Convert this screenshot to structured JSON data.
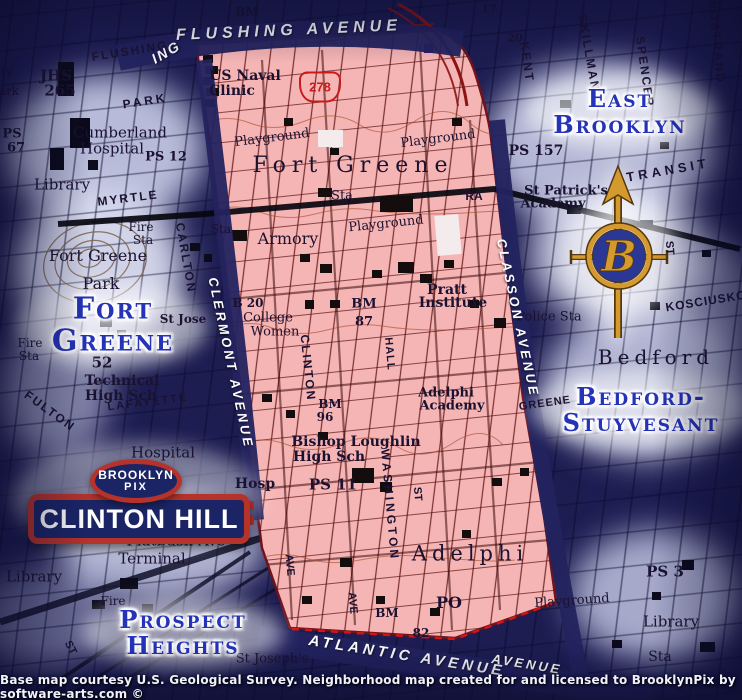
{
  "palette": {
    "ink": "#1a1230",
    "white": "#ffffff",
    "label_blue": "#2433b8",
    "pink": "#f6b5b5",
    "band_blue": "#23235f",
    "sign_red": "#b5332a",
    "sign_navy": "#1b2566",
    "gold": "#d59a2e",
    "shield_red": "#cc1a1a"
  },
  "banners": {
    "flushing": "FLUSHING AVENUE",
    "atlantic": "ATLANTIC AVENUE",
    "clermont": "CLERMONT AVENUE",
    "classon": "CLASSON AVENUE"
  },
  "sign": {
    "oval_top": "BROOKLYN",
    "oval_bottom": "PIX",
    "name": "CLINTON HILL"
  },
  "logo": {
    "letter": "B"
  },
  "shield": {
    "number": "278"
  },
  "footer": {
    "text": "Base map courtesy U.S. Geological Survey. Neighborhood map created for and licensed to BrooklynPix by software-arts.com ©"
  },
  "neighborhoods": [
    {
      "id": "east-brooklyn",
      "lines": [
        "East",
        "Brooklyn"
      ],
      "x": 620,
      "y": 112,
      "s": 24
    },
    {
      "id": "fort-greene",
      "lines": [
        "Fort",
        "Greene"
      ],
      "x": 113,
      "y": 326,
      "s": 30
    },
    {
      "id": "bedford-stuyvesant",
      "lines": [
        "Bedford-",
        "Stuyvesant"
      ],
      "x": 641,
      "y": 410,
      "s": 24
    },
    {
      "id": "prospect-heights",
      "lines": [
        "Prospect",
        "Heights"
      ],
      "x": 183,
      "y": 633,
      "s": 24
    }
  ],
  "map_labels": [
    {
      "t": "JHS",
      "x": 56,
      "y": 76,
      "s": 15,
      "b": 1
    },
    {
      "t": "265",
      "x": 60,
      "y": 91,
      "s": 15,
      "b": 1
    },
    {
      "t": "FLUSHING",
      "x": 130,
      "y": 51,
      "r": -9,
      "f": "sans",
      "sp": 2,
      "s": 12,
      "b": 1
    },
    {
      "t": "PARK",
      "x": 145,
      "y": 101,
      "r": -9,
      "f": "sans",
      "sp": 3,
      "s": 12,
      "b": 1
    },
    {
      "t": "ty",
      "x": 7,
      "y": 72,
      "s": 12
    },
    {
      "t": "ark",
      "x": 9,
      "y": 91,
      "s": 12
    },
    {
      "t": "PS",
      "x": 12,
      "y": 134,
      "s": 13,
      "b": 1
    },
    {
      "t": "67",
      "x": 16,
      "y": 148,
      "s": 13,
      "b": 1
    },
    {
      "t": "Cumberland",
      "x": 120,
      "y": 133,
      "s": 15
    },
    {
      "t": "Hospital",
      "x": 112,
      "y": 149,
      "s": 15
    },
    {
      "t": "PS 12",
      "x": 166,
      "y": 157,
      "s": 13,
      "b": 1
    },
    {
      "t": "Library",
      "x": 62,
      "y": 185,
      "s": 15
    },
    {
      "t": "MYRTLE",
      "x": 128,
      "y": 198,
      "r": -7,
      "f": "sans",
      "sp": 2,
      "s": 12,
      "b": 1
    },
    {
      "t": "Fire",
      "x": 141,
      "y": 227,
      "s": 12
    },
    {
      "t": "Sta",
      "x": 143,
      "y": 240,
      "s": 12
    },
    {
      "t": "Fort Greene",
      "x": 98,
      "y": 256,
      "s": 16
    },
    {
      "t": "Park",
      "x": 101,
      "y": 284,
      "s": 16
    },
    {
      "t": "CARLTON",
      "x": 186,
      "y": 258,
      "r": 80,
      "f": "sans",
      "sp": 2,
      "s": 12,
      "b": 1
    },
    {
      "t": "St Jose",
      "x": 183,
      "y": 319,
      "s": 12,
      "b": 1
    },
    {
      "t": "Fire",
      "x": 30,
      "y": 343,
      "s": 12
    },
    {
      "t": "Sta",
      "x": 29,
      "y": 356,
      "s": 12
    },
    {
      "t": "52",
      "x": 102,
      "y": 363,
      "s": 15,
      "b": 1
    },
    {
      "t": "Technical",
      "x": 122,
      "y": 381,
      "s": 14,
      "b": 1
    },
    {
      "t": "High Sch",
      "x": 121,
      "y": 396,
      "s": 14,
      "b": 1
    },
    {
      "t": "FULTON",
      "x": 50,
      "y": 411,
      "r": 36,
      "f": "sans",
      "sp": 2,
      "s": 12,
      "b": 1
    },
    {
      "t": "LAFAYETTE",
      "x": 148,
      "y": 403,
      "r": -7,
      "f": "sans",
      "sp": 2,
      "s": 11,
      "b": 1
    },
    {
      "t": "Hospital",
      "x": 163,
      "y": 453,
      "s": 15
    },
    {
      "t": "Flatbush Ave",
      "x": 176,
      "y": 541,
      "s": 15
    },
    {
      "t": "Terminal",
      "x": 152,
      "y": 559,
      "s": 15
    },
    {
      "t": "Library",
      "x": 34,
      "y": 577,
      "s": 15
    },
    {
      "t": "Fire",
      "x": 113,
      "y": 601,
      "s": 12
    },
    {
      "t": "ST",
      "x": 70,
      "y": 648,
      "r": 62,
      "f": "sans",
      "s": 11,
      "b": 1
    },
    {
      "t": "St Joseph's",
      "x": 272,
      "y": 659,
      "s": 13
    },
    {
      "t": "17",
      "x": 489,
      "y": 9,
      "s": 11,
      "b": 1
    },
    {
      "t": "20",
      "x": 515,
      "y": 38,
      "s": 11,
      "b": 1
    },
    {
      "t": "KENT",
      "x": 527,
      "y": 62,
      "r": 82,
      "f": "sans",
      "sp": 2,
      "s": 12,
      "b": 1
    },
    {
      "t": "SKILLMAN",
      "x": 589,
      "y": 53,
      "r": 80,
      "f": "sans",
      "sp": 2,
      "s": 12,
      "b": 1
    },
    {
      "t": "SPENCER",
      "x": 645,
      "y": 72,
      "r": 82,
      "f": "sans",
      "sp": 2,
      "s": 12,
      "b": 1
    },
    {
      "t": "NOSTRAND",
      "x": 717,
      "y": 42,
      "r": 84,
      "f": "sans",
      "sp": 2,
      "s": 12,
      "b": 1
    },
    {
      "t": "PS 157",
      "x": 536,
      "y": 151,
      "s": 14,
      "b": 1
    },
    {
      "t": "TRANSIT",
      "x": 668,
      "y": 170,
      "r": -10,
      "f": "sans",
      "sp": 4,
      "s": 13,
      "b": 1
    },
    {
      "t": "St Patrick's",
      "x": 566,
      "y": 191,
      "s": 13,
      "b": 1
    },
    {
      "t": "Academy",
      "x": 553,
      "y": 204,
      "s": 13,
      "b": 1
    },
    {
      "t": "ST",
      "x": 669,
      "y": 248,
      "r": 85,
      "f": "sans",
      "s": 11,
      "b": 1
    },
    {
      "t": "Police Sta",
      "x": 549,
      "y": 317,
      "s": 13
    },
    {
      "t": "Bedford",
      "x": 656,
      "y": 357,
      "s": 20,
      "sp": 5
    },
    {
      "t": "GREENE",
      "x": 545,
      "y": 404,
      "r": -8,
      "f": "sans",
      "sp": 1,
      "s": 11,
      "b": 1
    },
    {
      "t": "KOSCIUSKO",
      "x": 706,
      "y": 301,
      "r": -9,
      "f": "sans",
      "sp": 1,
      "s": 12,
      "b": 1
    },
    {
      "t": "PS 3",
      "x": 665,
      "y": 572,
      "s": 15,
      "b": 1
    },
    {
      "t": "Library",
      "x": 671,
      "y": 622,
      "s": 15
    },
    {
      "t": "Sta",
      "x": 660,
      "y": 657,
      "s": 14
    },
    {
      "t": "Playground",
      "x": 572,
      "y": 601,
      "r": -4,
      "s": 13
    },
    {
      "t": "BM",
      "x": 247,
      "y": 12,
      "s": 12,
      "b": 1
    },
    {
      "t": "ING",
      "x": 166,
      "y": 52,
      "r": -30,
      "c": "white",
      "f": "sans",
      "i": 1,
      "b": 1,
      "s": 14,
      "sp": 2
    },
    {
      "t": "US Naval",
      "x": 245,
      "y": 76,
      "s": 14,
      "b": 1
    },
    {
      "t": "Clinic",
      "x": 232,
      "y": 91,
      "s": 14,
      "b": 1
    },
    {
      "t": "Playground",
      "x": 272,
      "y": 138,
      "r": -7,
      "s": 13
    },
    {
      "t": "Playground",
      "x": 438,
      "y": 139,
      "r": -7,
      "s": 13
    },
    {
      "t": "Fort Greene",
      "x": 353,
      "y": 166,
      "s": 22,
      "sp": 6
    },
    {
      "t": "Sta",
      "x": 342,
      "y": 196,
      "s": 13
    },
    {
      "t": "Sta",
      "x": 221,
      "y": 229,
      "s": 12
    },
    {
      "t": "RA",
      "x": 474,
      "y": 196,
      "f": "sans",
      "s": 12,
      "b": 1
    },
    {
      "t": "Playground",
      "x": 386,
      "y": 224,
      "r": -6,
      "s": 13
    },
    {
      "t": "Armory",
      "x": 288,
      "y": 239,
      "s": 16
    },
    {
      "t": "B 20",
      "x": 248,
      "y": 303,
      "s": 12,
      "b": 1
    },
    {
      "t": "College",
      "x": 268,
      "y": 318,
      "s": 13
    },
    {
      "t": "Women",
      "x": 275,
      "y": 332,
      "s": 13
    },
    {
      "t": "BM",
      "x": 364,
      "y": 304,
      "s": 13,
      "b": 1
    },
    {
      "t": "87",
      "x": 364,
      "y": 322,
      "s": 13,
      "b": 1
    },
    {
      "t": "Pratt",
      "x": 447,
      "y": 290,
      "s": 14,
      "b": 1
    },
    {
      "t": "Institute",
      "x": 453,
      "y": 303,
      "s": 14,
      "b": 1
    },
    {
      "t": "CLINTON",
      "x": 308,
      "y": 368,
      "r": 84,
      "f": "sans",
      "sp": 2,
      "s": 12,
      "b": 1
    },
    {
      "t": "HALL",
      "x": 389,
      "y": 354,
      "r": 85,
      "f": "sans",
      "sp": 1,
      "s": 11,
      "b": 1
    },
    {
      "t": "Adelphi",
      "x": 446,
      "y": 393,
      "s": 13,
      "b": 1
    },
    {
      "t": "Academy",
      "x": 452,
      "y": 406,
      "s": 13,
      "b": 1
    },
    {
      "t": "BM",
      "x": 330,
      "y": 404,
      "s": 12,
      "b": 1
    },
    {
      "t": "96",
      "x": 325,
      "y": 417,
      "s": 12,
      "b": 1
    },
    {
      "t": "Bishop Loughlin",
      "x": 356,
      "y": 442,
      "s": 14,
      "b": 1
    },
    {
      "t": "High Sch",
      "x": 329,
      "y": 457,
      "s": 14,
      "b": 1
    },
    {
      "t": "PS 11",
      "x": 333,
      "y": 485,
      "s": 15,
      "b": 1
    },
    {
      "t": "WASHINGTON",
      "x": 390,
      "y": 505,
      "r": 85,
      "f": "sans",
      "sp": 3,
      "s": 12,
      "b": 1
    },
    {
      "t": "ST",
      "x": 417,
      "y": 494,
      "r": 85,
      "f": "sans",
      "s": 11,
      "b": 1
    },
    {
      "t": "Hosp",
      "x": 255,
      "y": 484,
      "s": 14,
      "b": 1
    },
    {
      "t": "AVE",
      "x": 289,
      "y": 565,
      "r": 85,
      "f": "sans",
      "s": 11,
      "b": 1
    },
    {
      "t": "AVE",
      "x": 352,
      "y": 603,
      "r": 85,
      "f": "sans",
      "s": 11,
      "b": 1
    },
    {
      "t": "Adelphi",
      "x": 470,
      "y": 554,
      "s": 21,
      "sp": 5
    },
    {
      "t": "PO",
      "x": 449,
      "y": 603,
      "s": 16,
      "b": 1
    },
    {
      "t": "BM",
      "x": 387,
      "y": 613,
      "s": 12,
      "b": 1
    },
    {
      "t": "82",
      "x": 421,
      "y": 633,
      "s": 12,
      "b": 1
    },
    {
      "t": "AVENUE",
      "x": 527,
      "y": 664,
      "r": 9,
      "c": "white",
      "f": "sans",
      "i": 1,
      "b": 1,
      "s": 13,
      "sp": 3
    }
  ]
}
